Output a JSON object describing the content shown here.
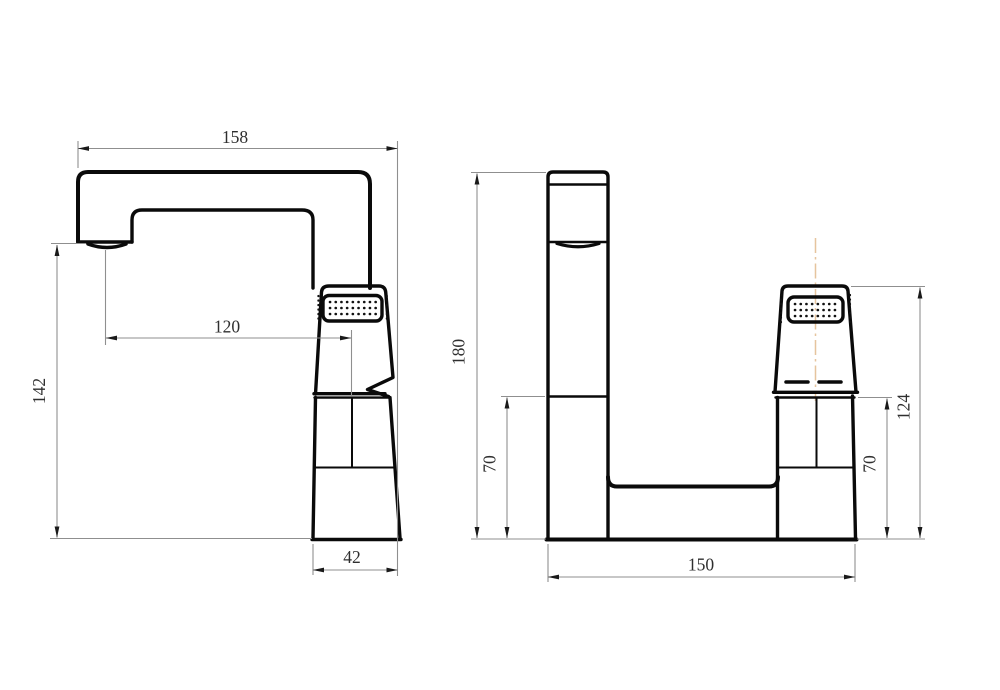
{
  "drawing": {
    "type": "technical-drawing",
    "subject": "basin faucet two-view dimensioned drawing",
    "units": "mm",
    "background": "#ffffff",
    "line_colors": {
      "outline": "#0a0a0a",
      "dimension_line": "#8f8f8f",
      "arrow": "#1a1a1a",
      "dimension_text": "#2f2f2f",
      "centerline": "#e6c49e"
    },
    "views": {
      "side": {
        "label": "side view",
        "dims": {
          "spout_reach_top": "158",
          "spout_offset": "120",
          "spout_height": "142",
          "body_width": "42"
        }
      },
      "front": {
        "label": "front view",
        "dims": {
          "overall_height": "180",
          "deck_height_left": "70",
          "deck_height_right": "70",
          "handle_height": "124",
          "base_width": "150"
        }
      }
    }
  }
}
